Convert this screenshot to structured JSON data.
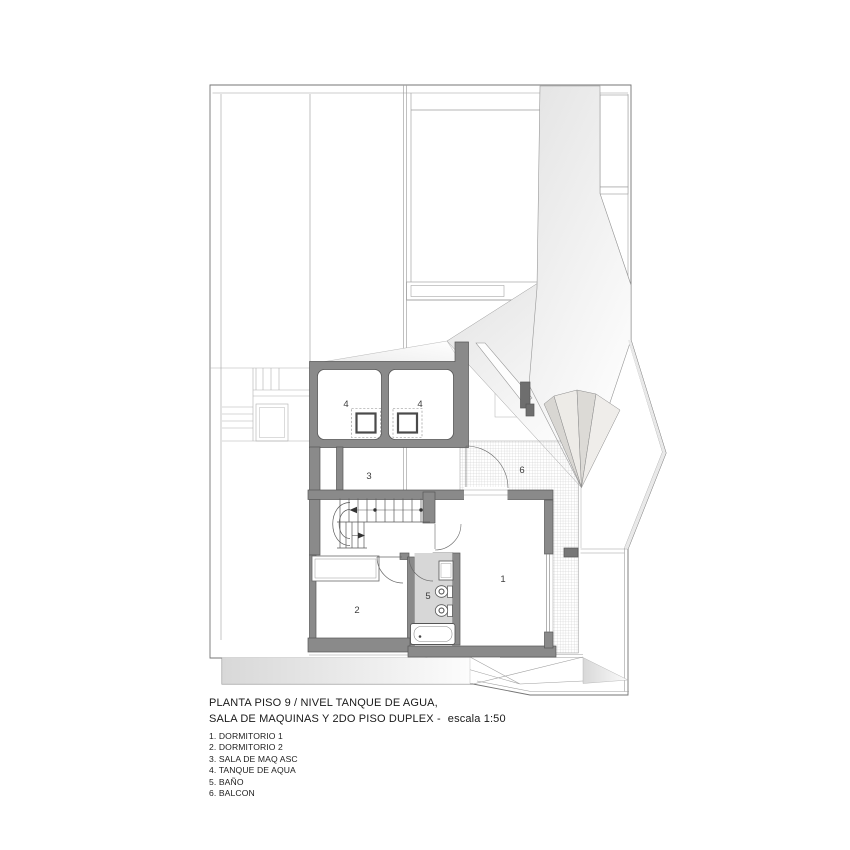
{
  "drawing": {
    "title_line1": "PLANTA PISO 9 / NIVEL TANQUE DE AGUA,",
    "title_line2": "SALA DE MAQUINAS Y 2DO PISO DUPLEX -",
    "scale_note": "escala 1:50",
    "legend_items": [
      "1. DORMITORIO 1",
      "2. DORMITORIO 2",
      "3. SALA DE MAQ ASC",
      "4. TANQUE DE AQUA",
      "5. BAÑO",
      "6. BALCON"
    ],
    "room_labels": [
      "4",
      "4",
      "3",
      "6",
      "1",
      "2",
      "5"
    ],
    "colors": {
      "wall_gray": "#8a8a8a",
      "wall_dark": "#6e6e6e",
      "bath_floor": "#d7d7d7",
      "hatch_line": "#c4c4c4",
      "thin_line": "#9e9e9e",
      "shade_light": "#e7e7e7",
      "text": "#161616"
    }
  }
}
